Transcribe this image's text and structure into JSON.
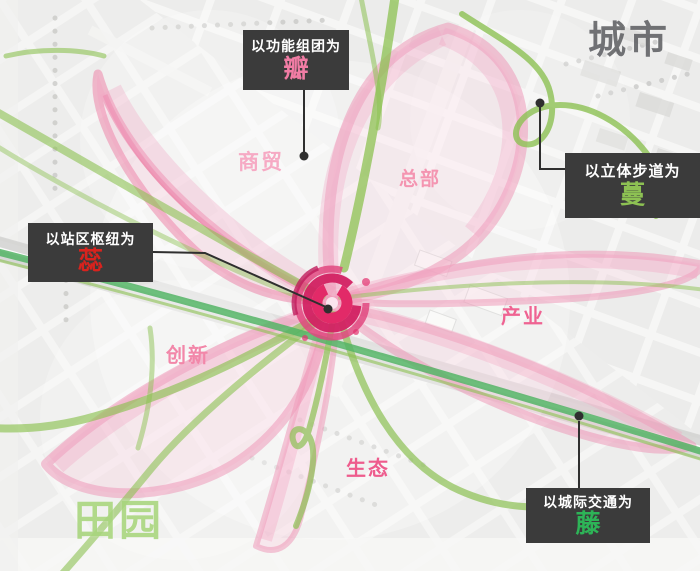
{
  "canvas": {
    "width": 700,
    "height": 571
  },
  "region_labels": {
    "city": {
      "text": "城市",
      "color": "#55565a"
    },
    "countryside": {
      "text": "田园",
      "color": "#a7d47c"
    }
  },
  "callouts": {
    "petal": {
      "prefix": "以功能组团为",
      "keyword": "瓣",
      "keyword_color": "#f07ca4"
    },
    "walkway": {
      "prefix": "以立体步道为",
      "keyword": "蔓",
      "keyword_color": "#8dc153"
    },
    "hub": {
      "prefix": "以站区枢纽为",
      "keyword": "蕊",
      "keyword_color": "#d8231e"
    },
    "transit": {
      "prefix": "以城际交通为",
      "keyword": "藤",
      "keyword_color": "#2db457"
    }
  },
  "district_labels": {
    "commerce": {
      "text": "商贸",
      "color": "#f6aac4"
    },
    "headquarters": {
      "text": "总部",
      "color": "#f495b1"
    },
    "industry": {
      "text": "产业",
      "color": "#ef6392"
    },
    "innovation": {
      "text": "创新",
      "color": "#f287a9"
    },
    "ecology": {
      "text": "生态",
      "color": "#ee5c8d"
    }
  },
  "theme": {
    "callout_box_bg": "#3b3b3b",
    "callout_text": "#ffffff",
    "petal_pink": "#f0a0bf",
    "petal_rim": "#ec8ab0",
    "bloom_magenta": "#da2e6c",
    "vine_green": "#8cc152",
    "rail_green": "#53b465",
    "leader_line": "#2f2f2f",
    "map_base": "#ebebe9"
  }
}
